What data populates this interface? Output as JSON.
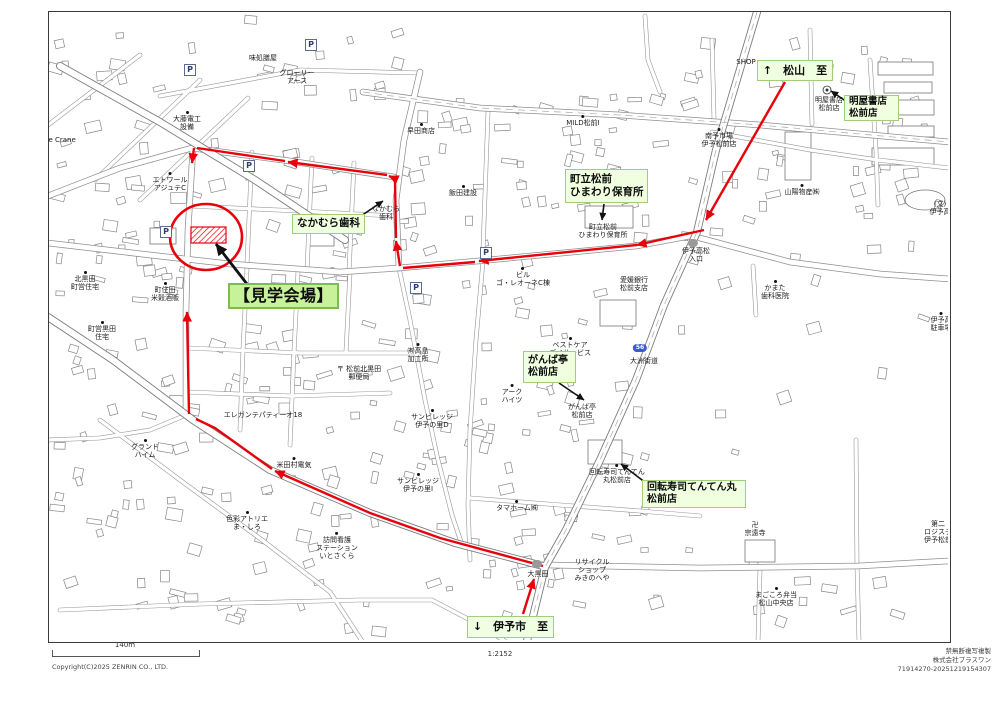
{
  "map": {
    "frame": {
      "x": 48,
      "y": 11,
      "w": 901,
      "h": 630
    },
    "green_labels": [
      {
        "id": "to-matsuyama",
        "x": 757,
        "y": 60,
        "w": 76,
        "h": 21,
        "fs": 11,
        "center": true,
        "big": false,
        "lines": [
          "↑　松山　至"
        ]
      },
      {
        "id": "haruya-shoten",
        "x": 844,
        "y": 95,
        "w": 55,
        "h": 26,
        "fs": 9.5,
        "center": false,
        "big": false,
        "lines": [
          "明屋書店",
          "松前店"
        ]
      },
      {
        "id": "hoikusho",
        "x": 565,
        "y": 169,
        "w": 83,
        "h": 34,
        "fs": 10.5,
        "center": false,
        "big": false,
        "lines": [
          "町立松前",
          "ひまわり保育所"
        ]
      },
      {
        "id": "nakamura",
        "x": 292,
        "y": 214,
        "w": 73,
        "h": 20,
        "fs": 10.5,
        "center": true,
        "big": false,
        "lines": [
          "なかむら歯科"
        ]
      },
      {
        "id": "kengaku-kaijo",
        "x": 228,
        "y": 283,
        "w": 111,
        "h": 26,
        "fs": 16,
        "center": true,
        "big": true,
        "lines": [
          "【見学会場】"
        ]
      },
      {
        "id": "ganbatei",
        "x": 523,
        "y": 351,
        "w": 53,
        "h": 32,
        "fs": 10,
        "center": false,
        "big": false,
        "lines": [
          "がんば亭",
          "松前店"
        ]
      },
      {
        "id": "tenten-maru",
        "x": 642,
        "y": 480,
        "w": 104,
        "h": 28,
        "fs": 10,
        "center": false,
        "big": false,
        "lines": [
          "回転寿司てんてん丸",
          "松前店"
        ]
      },
      {
        "id": "to-iyoshi",
        "x": 467,
        "y": 616,
        "w": 87,
        "h": 22,
        "fs": 11,
        "center": true,
        "big": false,
        "lines": [
          "↓　伊予市　至"
        ]
      }
    ],
    "small_labels": [
      {
        "x": 746,
        "y": 62,
        "dot": false,
        "lines": [
          "SHOP"
        ]
      },
      {
        "x": 829,
        "y": 104,
        "dot": false,
        "lines": [
          "明屋書店",
          "松前店"
        ]
      },
      {
        "x": 719,
        "y": 138,
        "dot": true,
        "lines": [
          "南予市場",
          "伊予松前店"
        ]
      },
      {
        "x": 802,
        "y": 190,
        "dot": true,
        "lines": [
          "山陽物産㈱"
        ]
      },
      {
        "x": 603,
        "y": 231,
        "dot": false,
        "lines": [
          "町立松前",
          "ひまわり保育所"
        ]
      },
      {
        "x": 421,
        "y": 129,
        "dot": true,
        "lines": [
          "早田商店"
        ]
      },
      {
        "x": 583,
        "y": 121,
        "dot": true,
        "lines": [
          "MILD松前Ⅰ"
        ]
      },
      {
        "x": 463,
        "y": 191,
        "dot": true,
        "lines": [
          "飯田建設"
        ]
      },
      {
        "x": 386,
        "y": 213,
        "dot": false,
        "lines": [
          "なかむら",
          "歯科"
        ]
      },
      {
        "x": 170,
        "y": 182,
        "dot": true,
        "lines": [
          "エトワール",
          "アジュテC"
        ]
      },
      {
        "x": 187,
        "y": 121,
        "dot": true,
        "lines": [
          "大藤電工",
          "設備"
        ]
      },
      {
        "x": 297,
        "y": 77,
        "dot": false,
        "lines": [
          "グローリー",
          "アース"
        ]
      },
      {
        "x": 263,
        "y": 58,
        "dot": false,
        "lines": [
          "味処膳屋"
        ]
      },
      {
        "x": 85,
        "y": 281,
        "dot": true,
        "lines": [
          "北黒田",
          "町営住宅"
        ]
      },
      {
        "x": 102,
        "y": 331,
        "dot": true,
        "lines": [
          "町営黒田",
          "住宅"
        ]
      },
      {
        "x": 165,
        "y": 292,
        "dot": true,
        "lines": [
          "町住田",
          "米穀酒販"
        ]
      },
      {
        "x": 263,
        "y": 415,
        "dot": false,
        "lines": [
          "エレガンテパティーオ18"
        ]
      },
      {
        "x": 145,
        "y": 449,
        "dot": true,
        "lines": [
          "グランド",
          "ハイム"
        ]
      },
      {
        "x": 294,
        "y": 463,
        "dot": true,
        "lines": [
          "米田村電気"
        ]
      },
      {
        "x": 247,
        "y": 521,
        "dot": true,
        "lines": [
          "色彩アトリエ",
          "ま・しろ"
        ]
      },
      {
        "x": 337,
        "y": 546,
        "dot": true,
        "lines": [
          "訪問看護",
          "ステーション",
          "いとさくら"
        ]
      },
      {
        "x": 359,
        "y": 373,
        "dot": false,
        "lines": [
          "〒 松前北黒田",
          "郵便局"
        ]
      },
      {
        "x": 418,
        "y": 353,
        "dot": true,
        "lines": [
          "㈲高島",
          "加工所"
        ]
      },
      {
        "x": 432,
        "y": 419,
        "dot": true,
        "lines": [
          "サンビレッジ",
          "伊予の里D"
        ]
      },
      {
        "x": 418,
        "y": 483,
        "dot": true,
        "lines": [
          "サンビレッジ",
          "伊予の里I"
        ]
      },
      {
        "x": 512,
        "y": 394,
        "dot": true,
        "lines": [
          "アーク",
          "ハイツ"
        ]
      },
      {
        "x": 582,
        "y": 411,
        "dot": false,
        "lines": [
          "がんば亭",
          "松前店"
        ]
      },
      {
        "x": 570,
        "y": 347,
        "dot": true,
        "lines": [
          "ベストケア",
          "デイサービス"
        ]
      },
      {
        "x": 644,
        "y": 361,
        "dot": false,
        "lines": [
          "大洲街道"
        ]
      },
      {
        "x": 617,
        "y": 474,
        "dot": true,
        "lines": [
          "回転寿司てんてん",
          "丸松前店"
        ]
      },
      {
        "x": 696,
        "y": 255,
        "dot": false,
        "lines": [
          "伊予高松",
          "入口"
        ]
      },
      {
        "x": 775,
        "y": 290,
        "dot": true,
        "lines": [
          "かまた",
          "歯科医院"
        ]
      },
      {
        "x": 755,
        "y": 529,
        "dot": false,
        "lines": [
          "卍",
          "宗遠寺"
        ]
      },
      {
        "x": 776,
        "y": 597,
        "dot": true,
        "lines": [
          "まごころ弁当",
          "松山中央店"
        ]
      },
      {
        "x": 938,
        "y": 532,
        "dot": false,
        "lines": [
          "第二",
          "ロジステ",
          "伊予松前"
        ]
      },
      {
        "x": 941,
        "y": 322,
        "dot": true,
        "lines": [
          "伊予高",
          "駐車場"
        ]
      },
      {
        "x": 940,
        "y": 208,
        "dot": false,
        "lines": [
          "(文)",
          "伊予高"
        ]
      },
      {
        "x": 592,
        "y": 570,
        "dot": false,
        "lines": [
          "リサイクル",
          "ショップ",
          "みきのへや"
        ]
      },
      {
        "x": 538,
        "y": 574,
        "dot": false,
        "lines": [
          "大黒田"
        ]
      },
      {
        "x": 517,
        "y": 506,
        "dot": true,
        "lines": [
          "タマホーム㈱"
        ]
      },
      {
        "x": 523,
        "y": 277,
        "dot": true,
        "lines": [
          "ビル",
          "ゴ・レオーネC棟"
        ]
      },
      {
        "x": 634,
        "y": 284,
        "dot": false,
        "lines": [
          "愛媛銀行",
          "松前支店"
        ]
      },
      {
        "x": 58,
        "y": 140,
        "dot": false,
        "lines": [
          "nce Crane"
        ]
      }
    ],
    "parking_marks": [
      [
        190,
        70
      ],
      [
        249,
        166
      ],
      [
        166,
        232
      ],
      [
        486,
        253
      ],
      [
        416,
        288
      ],
      [
        311,
        45
      ]
    ],
    "shields": [
      {
        "x": 640,
        "y": 348,
        "t": "56"
      }
    ],
    "signal_pills": [
      [
        537,
        564
      ],
      [
        693,
        243
      ]
    ],
    "bookstore_icon": {
      "x": 827,
      "y": 90
    }
  },
  "route": {
    "color": "#e8000a",
    "segments": [
      {
        "pts": [
          [
            785,
            82
          ],
          [
            706,
            220
          ]
        ],
        "arrow": true
      },
      {
        "pts": [
          [
            704,
            230
          ],
          [
            637,
            245
          ]
        ],
        "arrow": true
      },
      {
        "pts": [
          [
            637,
            245
          ],
          [
            479,
            261
          ]
        ],
        "arrow": true
      },
      {
        "pts": [
          [
            475,
            262
          ],
          [
            403,
            268
          ]
        ],
        "arrow": false
      },
      {
        "pts": [
          [
            400,
            266
          ],
          [
            396,
            241
          ]
        ],
        "arrow": true
      },
      {
        "pts": [
          [
            396,
            238
          ],
          [
            395,
            180
          ]
        ],
        "arrow": false
      },
      {
        "pts": [
          [
            396,
            179
          ],
          [
            389,
            176
          ]
        ],
        "arrow": true
      },
      {
        "pts": [
          [
            387,
            175
          ],
          [
            288,
            162
          ]
        ],
        "arrow": true
      },
      {
        "pts": [
          [
            285,
            161
          ],
          [
            197,
            148
          ]
        ],
        "arrow": false
      },
      {
        "pts": [
          [
            194,
            148
          ],
          [
            192,
            163
          ]
        ],
        "arrow": true
      },
      {
        "pts": [
          [
            523,
            614
          ],
          [
            534,
            579
          ]
        ],
        "arrow": true
      },
      {
        "pts": [
          [
            543,
            566
          ],
          [
            440,
            538
          ],
          [
            370,
            513
          ],
          [
            275,
            471
          ]
        ],
        "arrow": true
      },
      {
        "pts": [
          [
            272,
            469
          ],
          [
            215,
            428
          ],
          [
            196,
            419
          ]
        ],
        "arrow": false
      },
      {
        "pts": [
          [
            189,
            414
          ],
          [
            187,
            312
          ]
        ],
        "arrow": true
      }
    ]
  },
  "venue": {
    "circle": {
      "cx": 206,
      "cy": 237,
      "rx": 36,
      "ry": 33
    },
    "rect": {
      "x": 191,
      "y": 227,
      "w": 35,
      "h": 16
    },
    "color": "#e8000a"
  },
  "leaders": [
    {
      "pts": [
        [
          847,
          102
        ],
        [
          831,
          91
        ]
      ],
      "thick": false
    },
    {
      "pts": [
        [
          604,
          204
        ],
        [
          602,
          220
        ]
      ],
      "thick": false
    },
    {
      "pts": [
        [
          361,
          216
        ],
        [
          383,
          201
        ]
      ],
      "thick": false
    },
    {
      "pts": [
        [
          559,
          383
        ],
        [
          584,
          400
        ]
      ],
      "thick": false
    },
    {
      "pts": [
        [
          646,
          483
        ],
        [
          621,
          464
        ]
      ],
      "thick": false
    },
    {
      "pts": [
        [
          247,
          284
        ],
        [
          216,
          244
        ]
      ],
      "thick": true
    }
  ],
  "scale": {
    "bar_label": "140m",
    "ratio": "1:2152"
  },
  "credits": {
    "left": "Copyright(C)2025 ZENRIN CO., LTD.",
    "right": [
      "禁無断複写複製",
      "株式会社プラスワン",
      "71914270-20251219154307"
    ]
  }
}
